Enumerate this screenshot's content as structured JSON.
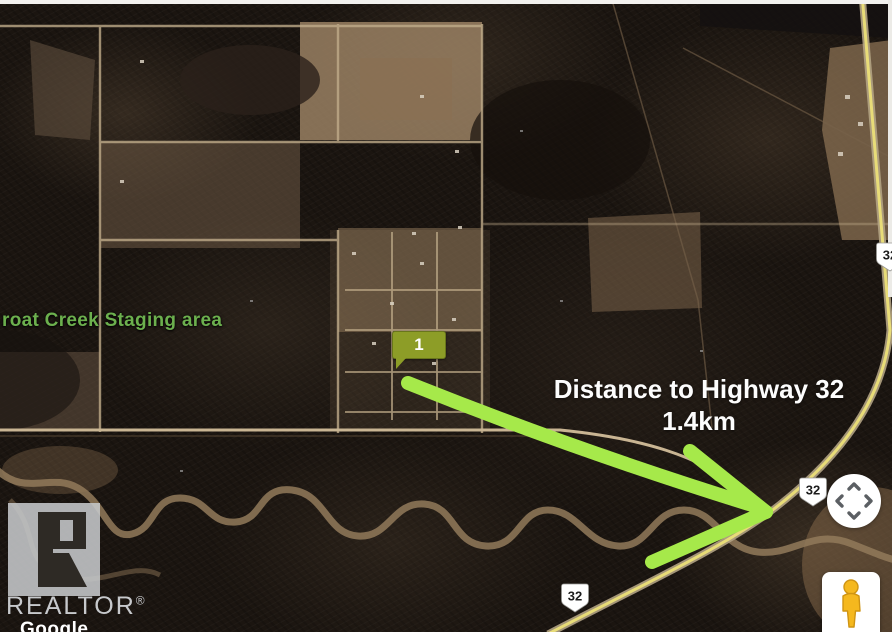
{
  "map": {
    "place_label": "roat Creek Staging area",
    "marker_label": "1",
    "annotation_line1": "Distance to Highway 32",
    "annotation_line2": "1.4km",
    "highway_badge_main": "32",
    "highway_badge_bottom": "32",
    "highway_badge_edge": "32"
  },
  "controls": {
    "pan_icon": "pan-arrows-icon",
    "pegman_icon": "pegman-street-view-icon"
  },
  "branding": {
    "realtor_logo": "REALTOR",
    "registered_symbol": "®",
    "watermark": "Google"
  },
  "colors": {
    "arrow_green": "#a6e94a",
    "marker_olive": "#8d9d27",
    "place_label_green": "#6cb04e",
    "highway_yellow": "#e8dc78"
  }
}
